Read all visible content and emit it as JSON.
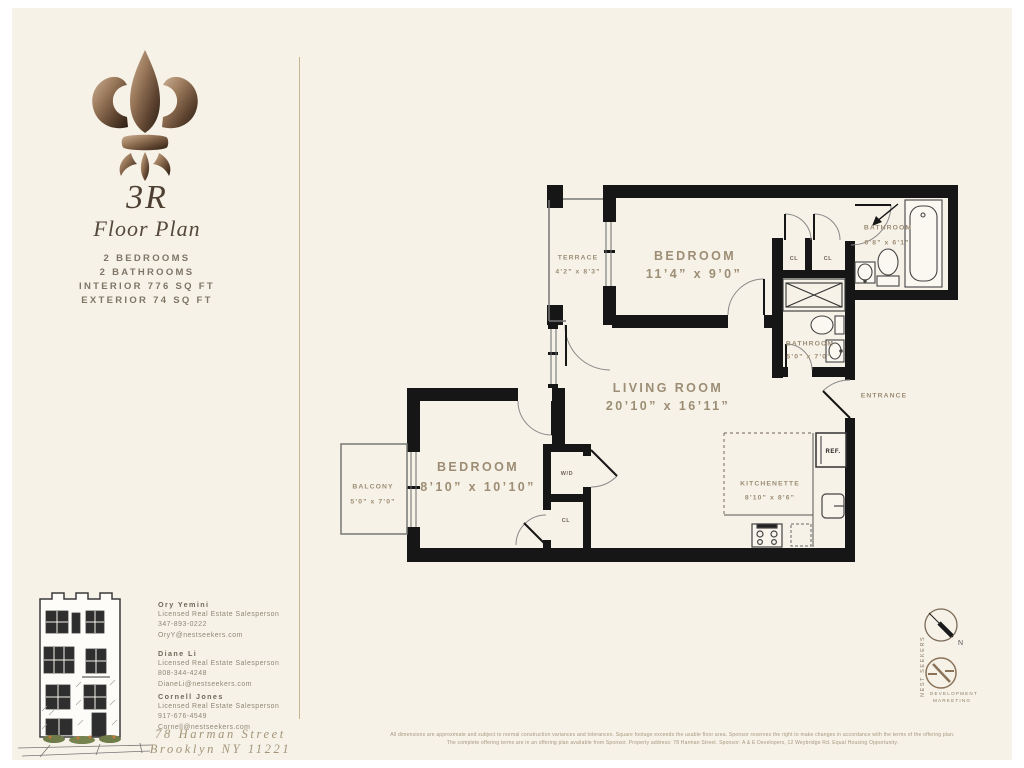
{
  "sidebar": {
    "unit": "3R",
    "subtitle": "Floor Plan",
    "facts": [
      "2 BEDROOMS",
      "2 BATHROOMS",
      "INTERIOR 776 SQ FT",
      "EXTERIOR 74 SQ FT"
    ]
  },
  "floorplan": {
    "living_room": {
      "label": "LIVING ROOM",
      "dims": "20’10” x 16’11”"
    },
    "bedroom_1": {
      "label": "BEDROOM",
      "dims": "11’4” x 9’0”"
    },
    "bedroom_2": {
      "label": "BEDROOM",
      "dims": "8’10” x 10’10”"
    },
    "bathroom_1": {
      "label": "BATHROOM",
      "dims": "6’8” x 6’1”"
    },
    "bathroom_2": {
      "label": "BATHROOM",
      "dims": "5’0” x 7’0”"
    },
    "terrace": {
      "label": "TERRACE",
      "dims": "4’2” x 8’3”"
    },
    "balcony": {
      "label": "BALCONY",
      "dims": "5’0” x 7’0”"
    },
    "kitchenette": {
      "label": "KITCHENETTE",
      "dims": "8’10” x 8’6”"
    },
    "entrance_label": "ENTRANCE",
    "closet1_label": "CL",
    "closet2_label": "CL",
    "closet3_label": "CL",
    "wd_label": "W/D",
    "ref_label": "REF."
  },
  "compass": {
    "north_label": "N"
  },
  "brand": {
    "name_vertical": "NEST SEEKERS",
    "tagline_line1": "DEVELOPMENT",
    "tagline_line2": "MARKETING"
  },
  "agents": [
    {
      "name": "Ory Yemini",
      "title": "Licensed Real Estate Salesperson",
      "phone": "347-893-0222",
      "email": "OryY@nestseekers.com"
    },
    {
      "name": "Diane Li",
      "title": "Licensed Real Estate Salesperson",
      "phone": "808-344-4248",
      "email": "DianeLi@nestseekers.com"
    },
    {
      "name": "Cornell Jones",
      "title": "Licensed Real Estate Salesperson",
      "phone": "917-676-4549",
      "email": "Cornell@nestseekers.com"
    }
  ],
  "address": {
    "line1": "78 Harman Street",
    "line2": "Brooklyn NY 11221"
  },
  "disclaimer": {
    "line1": "All dimensions are approximate and subject to normal construction variances and tolerances. Square footage exceeds the usable floor area. Sponsor reserves the right to make changes in accordance with the terms of the offering plan.",
    "line2": "The complete offering terms are in an offering plan available from Sponsor. Property address: 78 Harman Street. Sponsor: A & E Developers, 12 Weybridge Rd. Equal Housing Opportunity."
  },
  "colors": {
    "wall": "#161616",
    "paper": "#f7f2e8",
    "label": "#9c8d74",
    "bronze": "#8a6a4e"
  }
}
